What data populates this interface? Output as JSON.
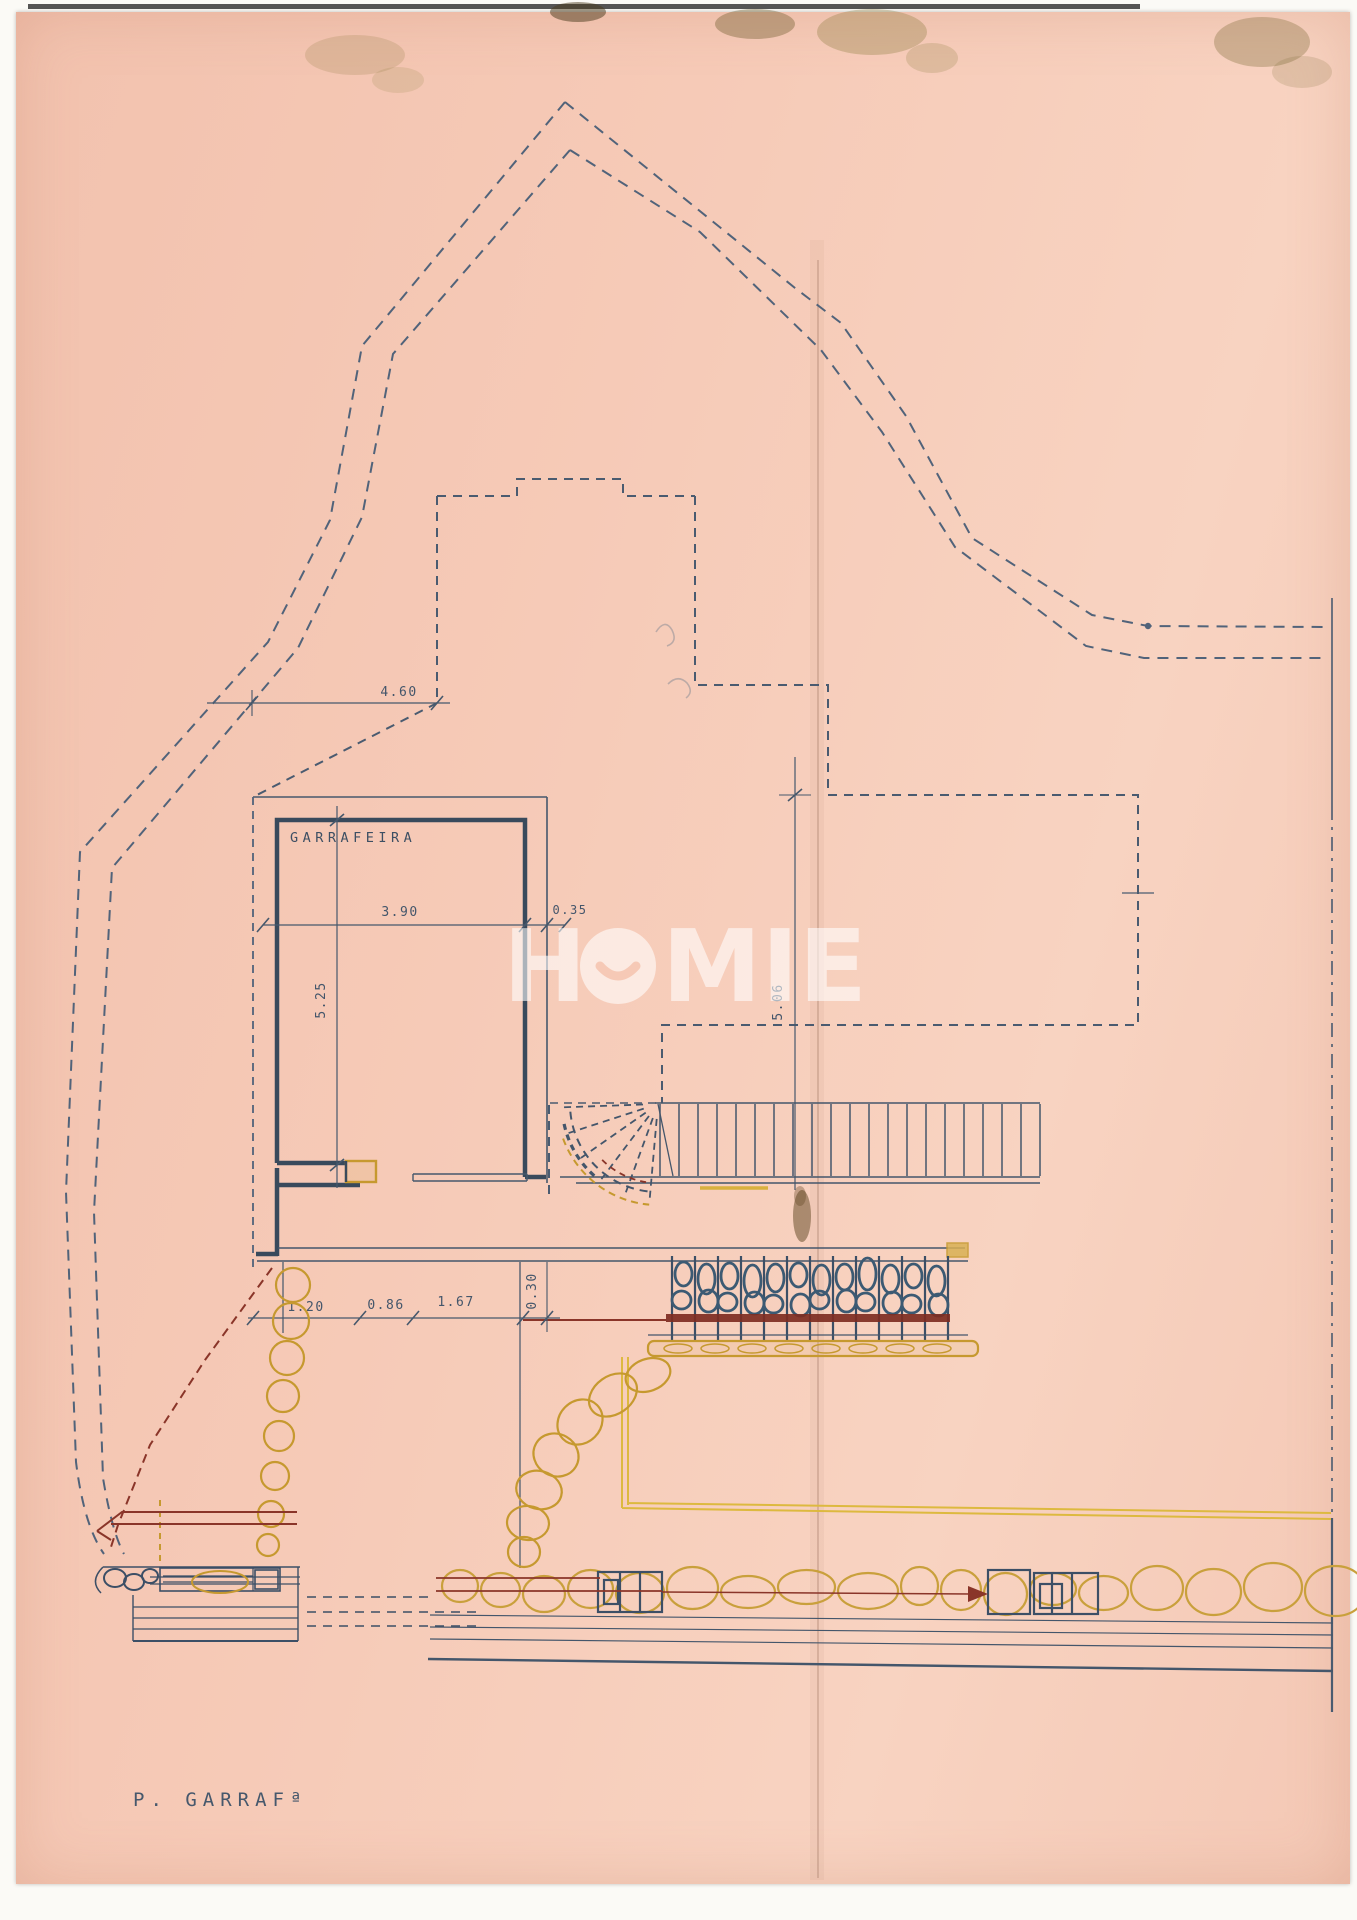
{
  "watermark": {
    "text": "HOMIE",
    "left_letter": "H",
    "right_letters": "MIE",
    "color": "#ffffff"
  },
  "plan": {
    "room_label": "GARRAFEIRA",
    "footer_label": "P. GARRAFª",
    "dimensions": {
      "top_width": "4.60",
      "room_width": "3.90",
      "wall_thickness": "0.35",
      "room_depth": "5.25",
      "right_depth": "5.06",
      "step_depth": "0.30",
      "terrace_seg_1": "1.20",
      "terrace_seg_2": "0.86",
      "terrace_seg_3": "1.67"
    },
    "ink_colors": {
      "navy_ink": "#44566b",
      "ochre_ink": "#c6992f",
      "red_ink": "#8a3529"
    },
    "paper_color": "#f6c9b6"
  }
}
